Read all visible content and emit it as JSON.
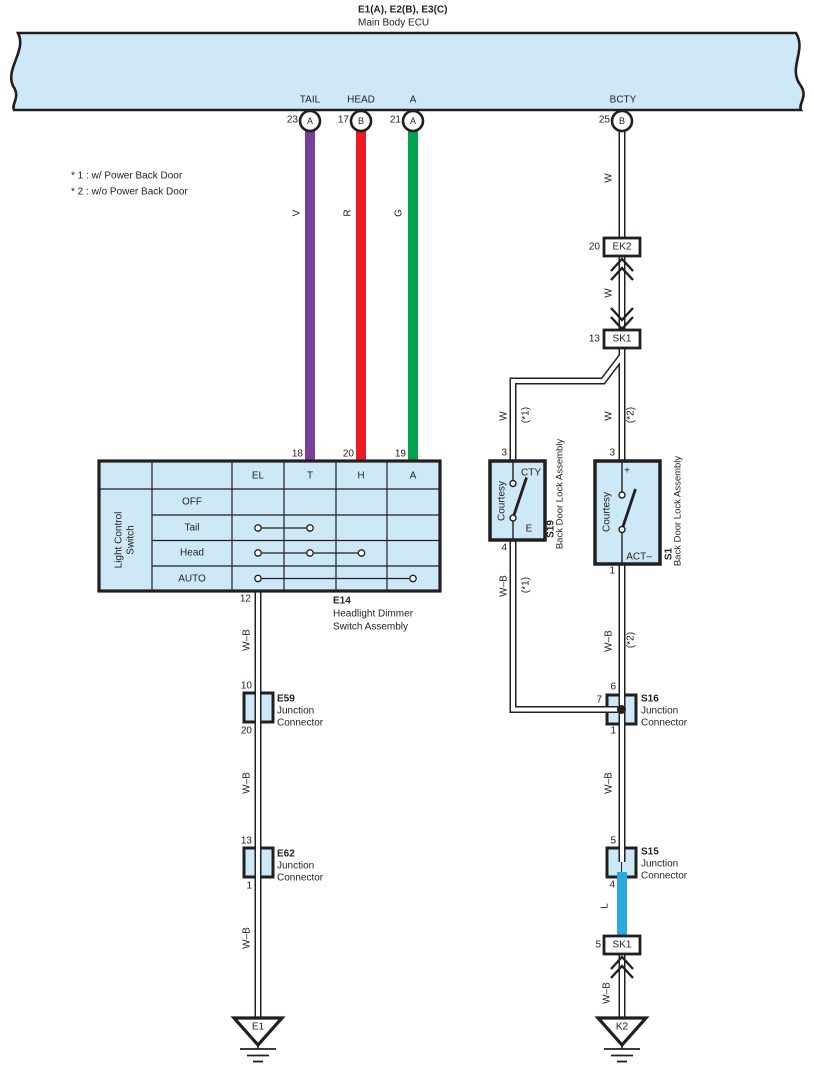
{
  "colors": {
    "panel_fill": "#cde9f8",
    "outline": "#231f20",
    "wire_violet": "#7a3f98",
    "wire_red": "#ec1c24",
    "wire_green": "#00a44e",
    "wire_blue": "#29abe2",
    "wire_white": "#ffffff"
  },
  "ecu": {
    "title": "E1(A), E2(B), E3(C)",
    "subtitle": "Main Body ECU",
    "pins": [
      {
        "label": "TAIL",
        "number": "23",
        "connector": "A"
      },
      {
        "label": "HEAD",
        "number": "17",
        "connector": "B"
      },
      {
        "label": "A",
        "number": "21",
        "connector": "A"
      },
      {
        "label": "BCTY",
        "number": "25",
        "connector": "B"
      }
    ]
  },
  "notes": {
    "note1": "* 1 : w/ Power Back Door",
    "note2": "* 2 : w/o Power Back Door"
  },
  "wire_codes": {
    "violet": "V",
    "red": "R",
    "green": "G",
    "white": "W",
    "white_black": "W–B",
    "blue": "L"
  },
  "variants": {
    "v1": "(*1)",
    "v2": "(*2)"
  },
  "connectors": {
    "ek2": {
      "pin": "20",
      "name": "EK2"
    },
    "sk1_upper": {
      "pin": "13",
      "name": "SK1"
    },
    "sk1_lower": {
      "pin": "5",
      "name": "SK1"
    },
    "e59": {
      "pin_top": "10",
      "pin_bottom": "20",
      "name": "E59",
      "desc1": "Junction",
      "desc2": "Connector"
    },
    "e62": {
      "pin_top": "13",
      "pin_bottom": "1",
      "name": "E62",
      "desc1": "Junction",
      "desc2": "Connector"
    },
    "s16": {
      "pin_top": "6",
      "pin_left": "7",
      "pin_bottom": "1",
      "name": "S16",
      "desc1": "Junction",
      "desc2": "Connector"
    },
    "s15": {
      "pin_top": "5",
      "pin_bottom": "4",
      "name": "S15",
      "desc1": "Junction",
      "desc2": "Connector"
    }
  },
  "switch_assembly": {
    "name": "E14",
    "desc1": "Headlight Dimmer",
    "desc2": "Switch Assembly",
    "side_label1": "Light Control",
    "side_label2": "Switch",
    "columns": [
      "EL",
      "T",
      "H",
      "A"
    ],
    "rows": [
      "OFF",
      "Tail",
      "Head",
      "AUTO"
    ],
    "pin_top_t": "18",
    "pin_top_h": "20",
    "pin_top_a": "19",
    "pin_bottom": "12",
    "connections": [
      {
        "position": "Tail",
        "terminals": [
          "EL",
          "T"
        ]
      },
      {
        "position": "Head",
        "terminals": [
          "EL",
          "T",
          "H"
        ]
      },
      {
        "position": "AUTO",
        "terminals": [
          "EL",
          "A"
        ]
      }
    ]
  },
  "door_lock_s19": {
    "pin_top": "3",
    "terminal_top": "CTY",
    "terminal_bottom": "E",
    "switch_label": "Courtesy",
    "name": "S19",
    "assembly": "Back Door Lock Assembly",
    "pin_bottom": "4"
  },
  "door_lock_s1": {
    "pin_top": "3",
    "terminal_top": "+",
    "terminal_bottom": "ACT–",
    "switch_label": "Courtesy",
    "name": "S1",
    "assembly": "Back Door Lock Assembly",
    "pin_bottom": "1"
  },
  "grounds": {
    "left": "E1",
    "right": "K2"
  }
}
